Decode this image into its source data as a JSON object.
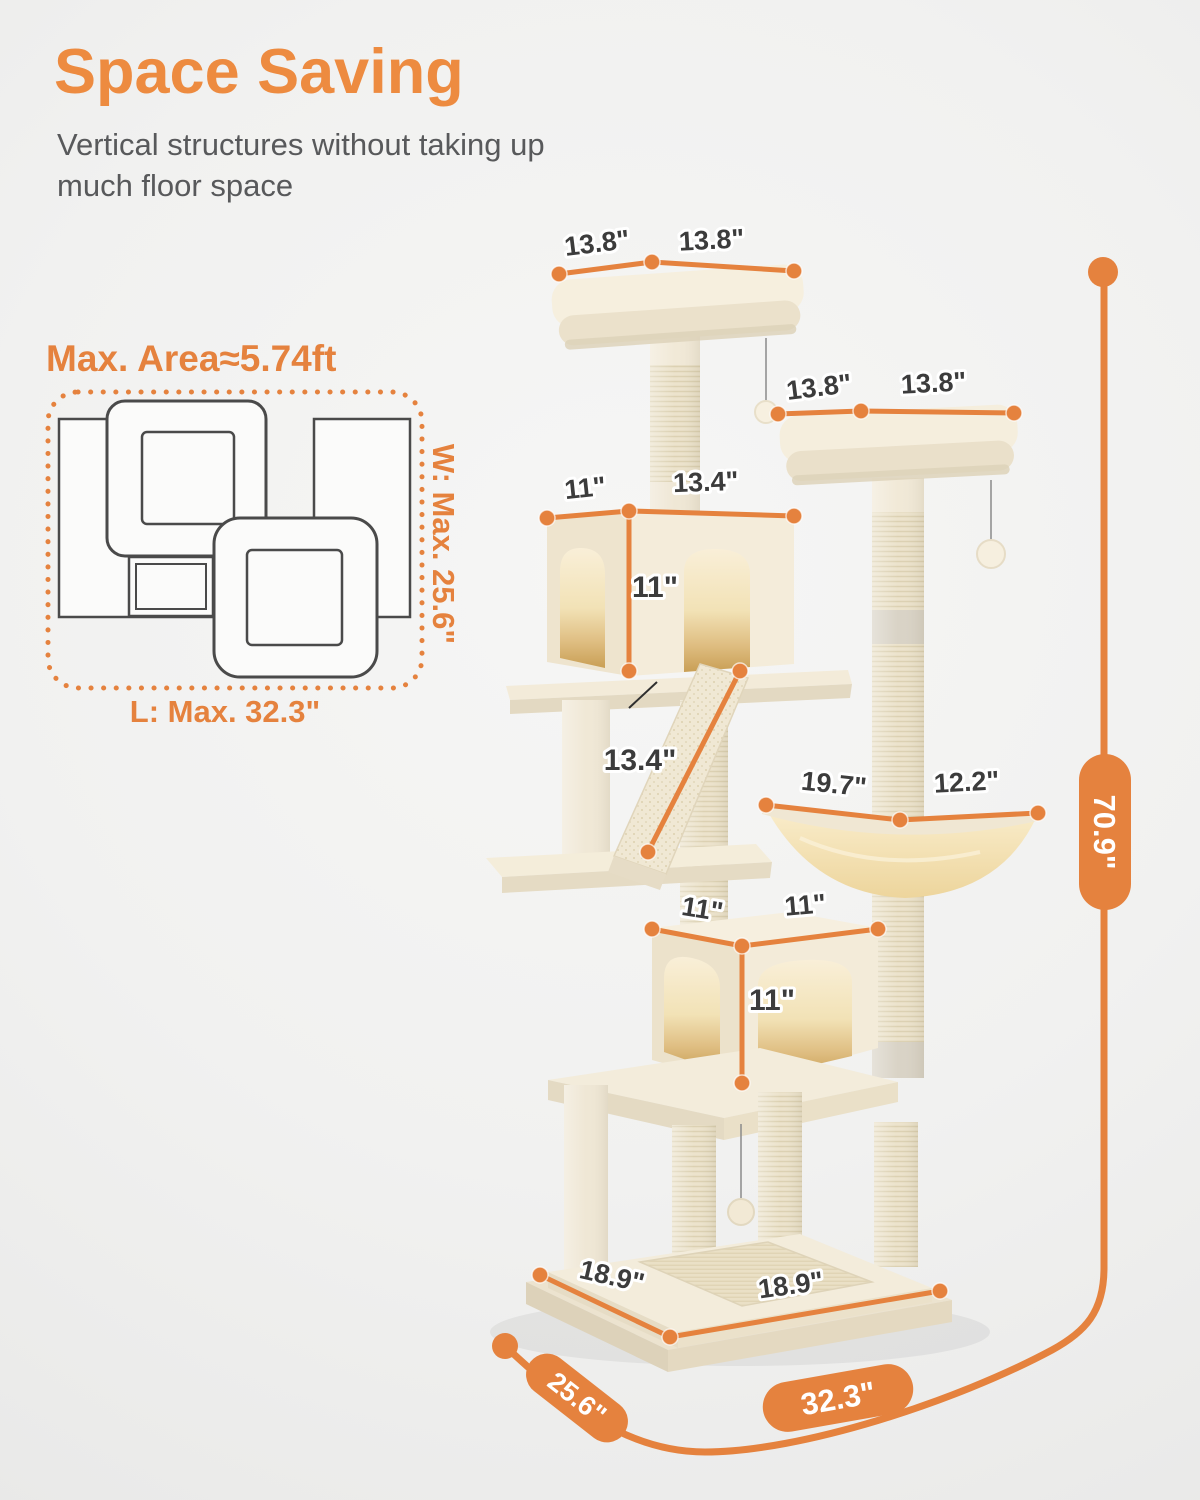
{
  "header": {
    "title": "Space Saving",
    "subtitle_line1": "Vertical structures without taking up",
    "subtitle_line2": "much floor space"
  },
  "floorplan": {
    "title": "Max. Area≈5.74ft",
    "width_label": "W: Max. 25.6\"",
    "length_label": "L: Max. 32.3\""
  },
  "dimensions": {
    "top_platform": {
      "left": "13.8\"",
      "right": "13.8\""
    },
    "second_platform": {
      "left": "13.8\"",
      "right": "13.8\""
    },
    "upper_condo": {
      "depth": "11\"",
      "width": "13.4\"",
      "height": "11\""
    },
    "ramp_length": "13.4\"",
    "hammock": {
      "width": "19.7\"",
      "depth": "12.2\""
    },
    "lower_condo": {
      "depth": "11\"",
      "width": "11\"",
      "height": "11\""
    },
    "base": {
      "left": "18.9\"",
      "right": "18.9\""
    },
    "overall": {
      "width": "25.6\"",
      "length": "32.3\"",
      "height": "70.9\""
    }
  },
  "colors": {
    "accent": "#E5823E",
    "heading": "#ED8B40"
  }
}
